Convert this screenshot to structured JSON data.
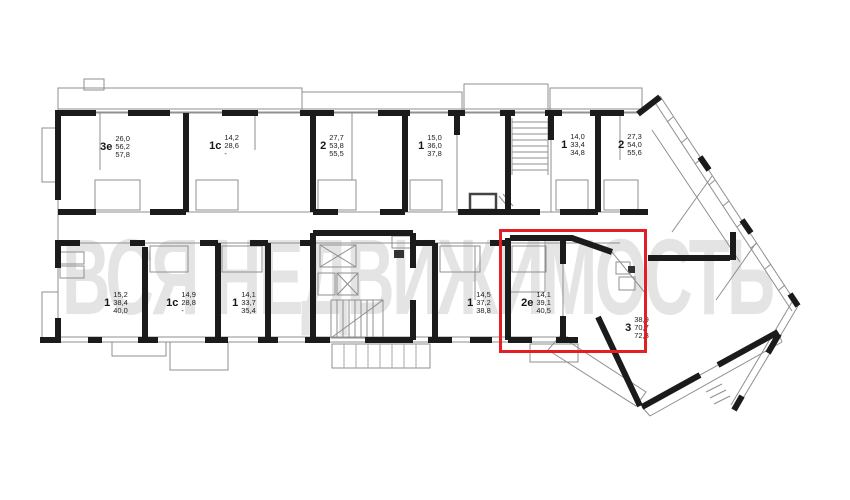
{
  "watermark": "ВСЯ НЕДВИЖИМОСТЬ",
  "highlight": {
    "apartment": "2е",
    "color": "#e31e24"
  },
  "apartments": [
    {
      "t": "3е",
      "n1": "26,0",
      "n2": "56,2",
      "n3": "57,8"
    },
    {
      "t": "1с",
      "n1": "14,2",
      "n2": "28,6",
      "n3": "-"
    },
    {
      "t": "2",
      "n1": "27,7",
      "n2": "53,8",
      "n3": "55,5"
    },
    {
      "t": "1",
      "n1": "15,0",
      "n2": "36,0",
      "n3": "37,8"
    },
    {
      "t": "1",
      "n1": "14,0",
      "n2": "33,4",
      "n3": "34,8"
    },
    {
      "t": "2",
      "n1": "27,3",
      "n2": "54,0",
      "n3": "55,6"
    },
    {
      "t": "1",
      "n1": "15,2",
      "n2": "38,4",
      "n3": "40,0"
    },
    {
      "t": "1с",
      "n1": "14,9",
      "n2": "28,8",
      "n3": "-"
    },
    {
      "t": "1",
      "n1": "14,1",
      "n2": "33,7",
      "n3": "35,4"
    },
    {
      "t": "1",
      "n1": "14,5",
      "n2": "37,2",
      "n3": "38,8"
    },
    {
      "t": "2е",
      "n1": "14,1",
      "n2": "39,1",
      "n3": "40,5"
    },
    {
      "t": "3",
      "n1": "38,9",
      "n2": "70,7",
      "n3": "72,3"
    }
  ]
}
